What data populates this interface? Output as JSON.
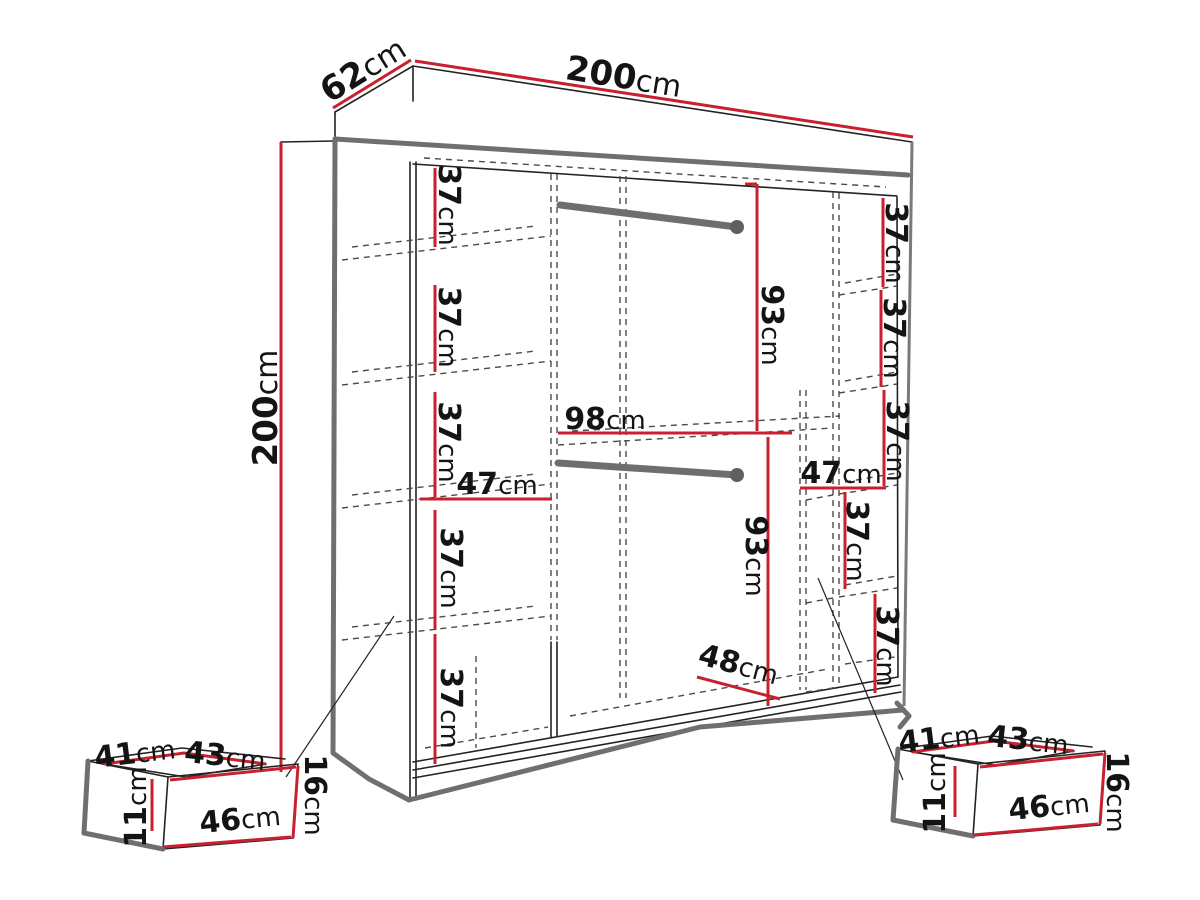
{
  "unit": "cm",
  "colors": {
    "dimension_red": "#c8202f",
    "outline_gray": "#6f6f6f",
    "line_black": "#232323"
  },
  "wardrobe": {
    "width": "200",
    "depth": "62",
    "height": "200",
    "left_column": {
      "gap_1": "37",
      "gap_2": "37",
      "gap_3": "37",
      "width": "47",
      "gap_4": "37",
      "gap_5": "37"
    },
    "middle_section": {
      "upper_width": "98",
      "upper_hanging_height": "93",
      "lower_hanging_height": "93",
      "lower_width": "48"
    },
    "right_column": {
      "gap_1": "37",
      "gap_2": "37",
      "gap_3": "37",
      "width": "47",
      "gap_4": "37",
      "gap_5": "37"
    }
  },
  "left_drawer": {
    "depth": "41",
    "top_width": "43",
    "side_height": "11",
    "front_width": "46",
    "front_height": "16"
  },
  "right_drawer": {
    "depth": "41",
    "top_width": "43",
    "side_height": "11",
    "front_width": "46",
    "front_height": "16"
  }
}
